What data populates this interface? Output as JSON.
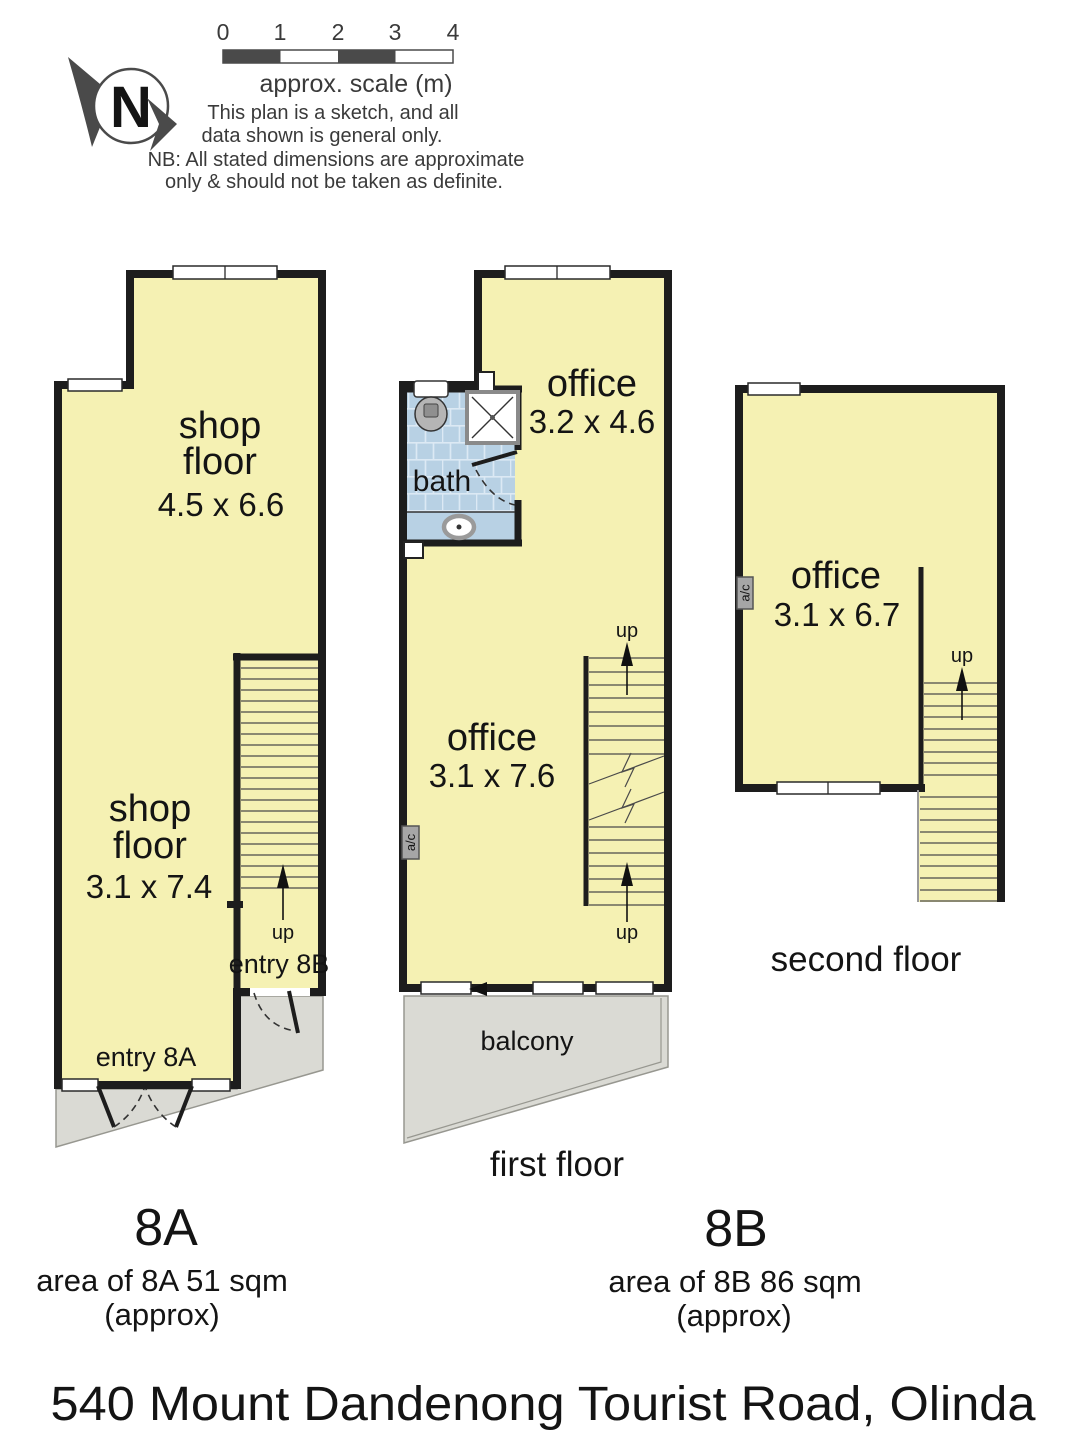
{
  "header": {
    "north_letter": "N",
    "scale_ticks": [
      "0",
      "1",
      "2",
      "3",
      "4"
    ],
    "scale_caption": "approx. scale (m)",
    "sketch_note_line1": "This plan is a sketch, and all",
    "sketch_note_line2": "data shown is general only.",
    "nb_note_line1": "NB: All stated dimensions are approximate",
    "nb_note_line2": "only & should not be taken as definite."
  },
  "plan_ground": {
    "shop_top": {
      "line1": "shop",
      "line2": "floor",
      "dims": "4.5 x 6.6"
    },
    "shop_bottom": {
      "line1": "shop",
      "line2": "floor",
      "dims": "3.1 x 7.4"
    },
    "up_label": "up",
    "entry_8b_label": "entry 8B",
    "entry_8a_label": "entry 8A"
  },
  "plan_first": {
    "office_top": {
      "name": "office",
      "dims": "3.2 x 4.6"
    },
    "bath_label": "bath",
    "office_main": {
      "name": "office",
      "dims": "3.1 x 7.6"
    },
    "up_top_label": "up",
    "up_bottom_label": "up",
    "ac_label": "a/c",
    "balcony_label": "balcony",
    "caption": "first floor"
  },
  "plan_second": {
    "office": {
      "name": "office",
      "dims": "3.1 x 6.7"
    },
    "up_label": "up",
    "ac_label": "a/c",
    "caption": "second floor"
  },
  "units": {
    "a": {
      "label": "8A",
      "area_line": "area of 8A 51 sqm",
      "approx_line": "(approx)"
    },
    "b": {
      "label": "8B",
      "area_line": "area of 8B 86 sqm",
      "approx_line": "(approx)"
    }
  },
  "footer": {
    "address": "540 Mount Dandenong Tourist Road, Olinda"
  },
  "colors": {
    "room_fill": "#f5f1b3",
    "bath_fill": "#b8d1e4",
    "tile_line": "#dce9f4",
    "outdoor_fill": "#dadad4",
    "wall": "#1d1d1d"
  }
}
